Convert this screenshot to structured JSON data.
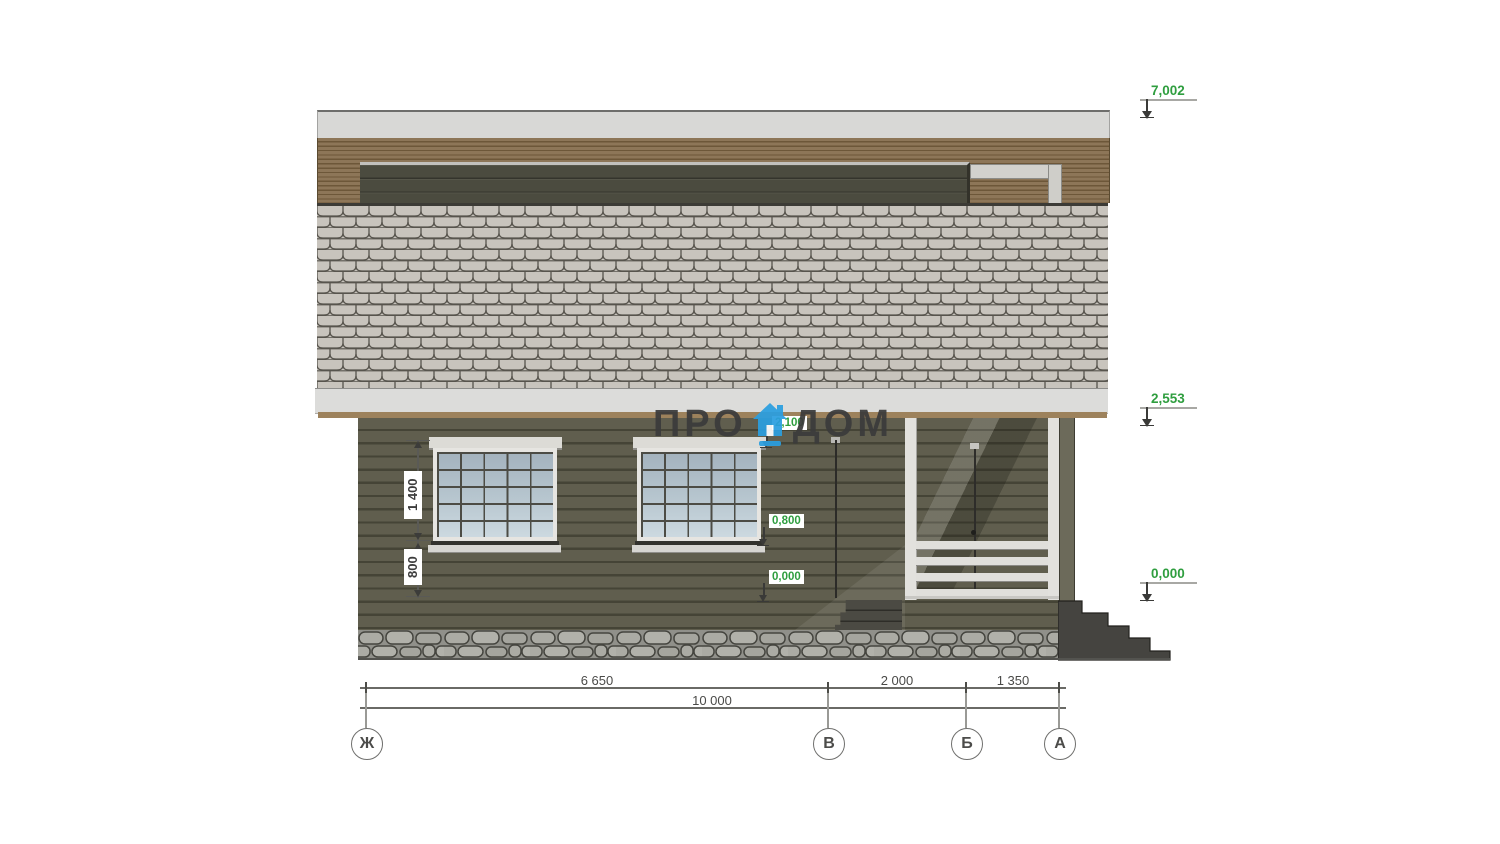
{
  "watermark": {
    "left": "ПРО",
    "right": "ДОМ"
  },
  "elevation_marks": [
    {
      "label": "7,002"
    },
    {
      "label": "2,553"
    },
    {
      "label": "0,000"
    }
  ],
  "level_labels": [
    {
      "label": "2,100"
    },
    {
      "label": "0,800"
    },
    {
      "label": "0,000"
    }
  ],
  "vertical_dims": [
    {
      "label": "1 400"
    },
    {
      "label": "800"
    }
  ],
  "horizontal_dims": [
    {
      "label": "6 650"
    },
    {
      "label": "2 000"
    },
    {
      "label": "1 350"
    },
    {
      "label": "10 000"
    }
  ],
  "axes": [
    {
      "label": "Ж"
    },
    {
      "label": "В"
    },
    {
      "label": "Б"
    },
    {
      "label": "А"
    }
  ],
  "colors": {
    "annotation_green": "#2f9e3f",
    "logo_blue": "#2b9fe0"
  }
}
